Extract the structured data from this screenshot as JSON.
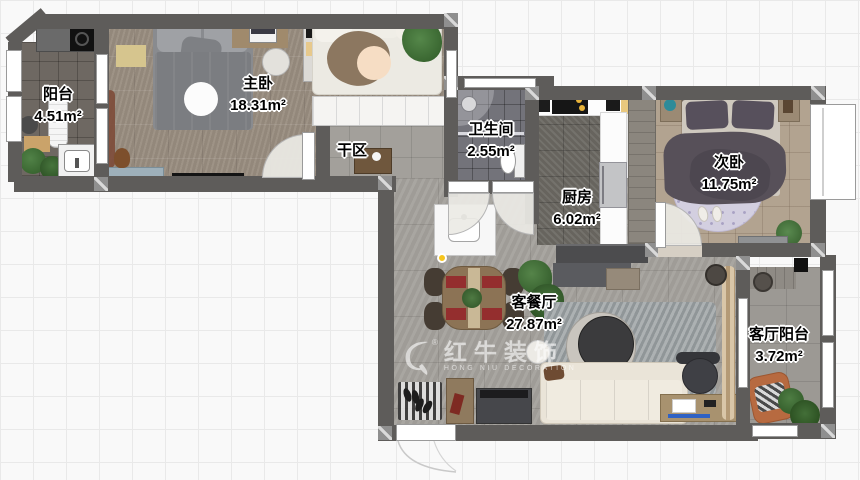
{
  "meta": {
    "type": "residential-floor-plan",
    "canvas_width": 860,
    "canvas_height": 480
  },
  "watermark": {
    "brand": "红牛装饰",
    "subtitle": "HONG NIU DECORATION",
    "registered": "®"
  },
  "rooms": [
    {
      "id": "balcony",
      "name": "阳台",
      "area": "4.51m²"
    },
    {
      "id": "master-bedroom",
      "name": "主卧",
      "area": "18.31m²"
    },
    {
      "id": "dry-area",
      "name": "干区",
      "area": ""
    },
    {
      "id": "bathroom",
      "name": "卫生间",
      "area": "2.55m²"
    },
    {
      "id": "kitchen",
      "name": "厨房",
      "area": "6.02m²"
    },
    {
      "id": "second-bedroom",
      "name": "次卧",
      "area": "11.75m²"
    },
    {
      "id": "living-dining",
      "name": "客餐厅",
      "area": "27.87m²"
    },
    {
      "id": "living-balcony",
      "name": "客厅阳台",
      "area": "3.72m²"
    }
  ],
  "colors": {
    "wall": "#5e5c5a",
    "grid_line": "#e9e9e9",
    "background": "#f9f9f9",
    "label_text": "#000000",
    "label_halo": "#ffffff",
    "watermark_text": "#ffffff",
    "master_floor": "#998d80",
    "living_floor": "#a4a19c",
    "bedroom2_floor": "#b2a390",
    "accent_chair": "#b76a40"
  }
}
